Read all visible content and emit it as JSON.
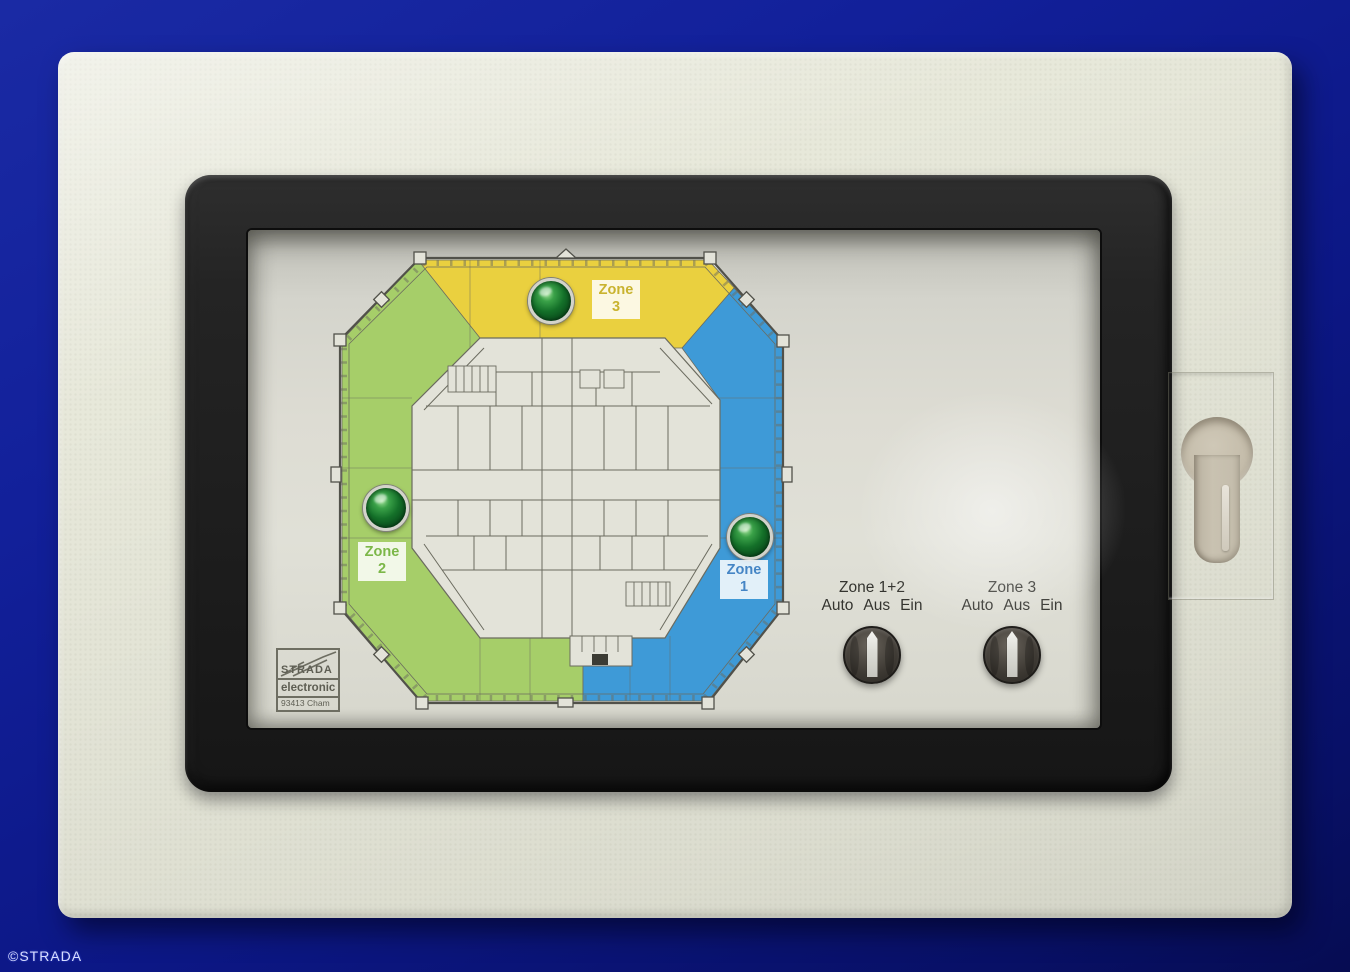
{
  "watermark": "©STRADA",
  "colors": {
    "background_navy": "#0c1785",
    "enclosure_beige": "#e7e8da",
    "frame_black": "#242424",
    "panel_aluminum": "#dddcd3",
    "zone1_blue": "#3e9ad7",
    "zone2_green": "#a6ce69",
    "zone3_yellow": "#ead03f",
    "led_green": "#147029"
  },
  "floorplan": {
    "zones": [
      {
        "id": "zone1",
        "label_line1": "Zone",
        "label_line2": "1",
        "color": "#3e9ad7",
        "led": "green-led-lit"
      },
      {
        "id": "zone2",
        "label_line1": "Zone",
        "label_line2": "2",
        "color": "#a6ce69",
        "led": "green-led-lit"
      },
      {
        "id": "zone3",
        "label_line1": "Zone",
        "label_line2": "3",
        "color": "#ead03f",
        "led": "green-led-lit"
      }
    ]
  },
  "switches": [
    {
      "title": "Zone 1+2",
      "options": [
        "Auto",
        "Aus",
        "Ein"
      ]
    },
    {
      "title": "Zone 3",
      "options": [
        "Auto",
        "Aus",
        "Ein"
      ]
    }
  ],
  "logo": {
    "brand": "STRADA",
    "line2": "electronic",
    "line3": "93413 Cham"
  }
}
